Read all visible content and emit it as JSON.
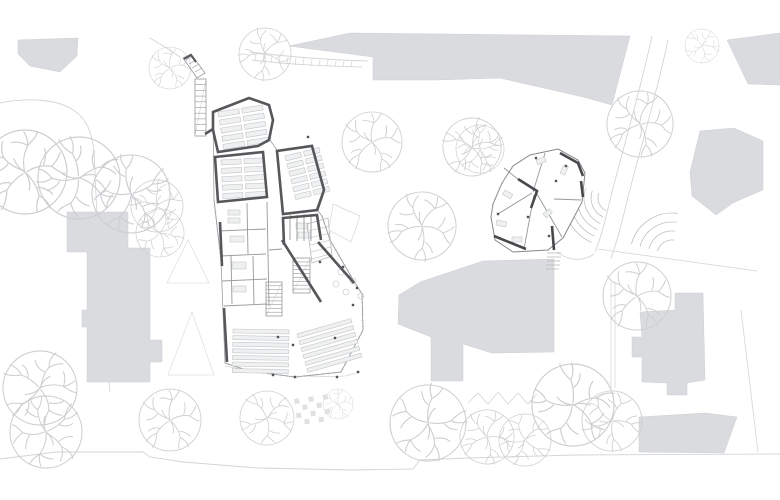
{
  "canvas": {
    "width": 780,
    "height": 500,
    "background": "#ffffff"
  },
  "palette": {
    "context_building_fill": "#d9dbde",
    "context_building_edge": "#cdcfd2",
    "wall": "#55575a",
    "wall_dark": "#47484b",
    "thin_wall": "#96989a",
    "glass": "#9b9d9f",
    "furniture_fill": "#eef0f1",
    "furniture_stroke": "#c3c5c7",
    "tree": "#ccced1",
    "path": "#d3d5d8",
    "detail": "#b6b8ba",
    "dot": "#515254",
    "plan_fill": "#ffffff"
  },
  "site": {
    "context_buildings": [
      {
        "name": "context-building-top-left",
        "points": "18,40 78,38 77,56 60,72 30,66 18,54"
      },
      {
        "name": "context-building-north-mass",
        "points": "289,46 350,33 630,36 612,105 583,97 500,78 437,80 373,80 373,57"
      },
      {
        "name": "context-building-top-right-corner",
        "points": "727,40 780,33 780,85 748,84"
      },
      {
        "name": "context-building-east-house",
        "points": "700,131 734,128 763,141 763,190 744,198 733,203 716,215 692,196 690,172"
      },
      {
        "name": "context-building-center-blob",
        "points": "420,282 483,261 554,259 554,352 492,353 463,344 463,381 431,381 431,337 398,324 399,295"
      },
      {
        "name": "context-building-west-tall",
        "points": "67,212 128,212 128,248 150,248 150,340 162,340 162,362 150,362 150,382 87,382 87,327 82,327 82,310 87,310 87,252 67,252"
      },
      {
        "name": "context-building-southeast-a",
        "points": "640,312 675,310 675,293 703,293 705,380 687,383 687,395 667,395 667,383 642,382 642,357 632,357 632,337 642,337"
      },
      {
        "name": "context-building-southeast-b",
        "points": "639,417 705,413 737,417 724,453 639,452"
      }
    ],
    "boundary_paths": [
      {
        "name": "site-path-west-boundary",
        "d": "M0,103 C30,97 55,100 70,108 C85,116 92,130 94,152 L96,195 C98,240 101,300 106,352 L110,392",
        "w": 0.9
      },
      {
        "name": "site-path-south-walk",
        "d": "M0,459 L56,452 L143,452 L150,457 L183,462 L258,468 L352,470 L413,469 L420,460 L468,458 L575,455 L780,454",
        "w": 0.9
      },
      {
        "name": "site-path-east-walk-a",
        "d": "M652,36 C640,92 622,152 610,200 C606,218 600,240 595,252",
        "w": 0.9
      },
      {
        "name": "site-path-east-walk-b",
        "d": "M668,40 C656,97 638,157 626,205 C622,222 616,245 611,258",
        "w": 0.9
      },
      {
        "name": "site-line-east-property",
        "d": "M598,249 L757,271",
        "w": 0.8
      },
      {
        "name": "site-line-southeast-property",
        "d": "M741,310 L758,452",
        "w": 0.8
      },
      {
        "name": "site-fence-east-1",
        "d": "M611,282 L611,388",
        "w": 0.7
      },
      {
        "name": "site-fence-east-2",
        "d": "M615,282 L615,388",
        "w": 0.7
      },
      {
        "name": "site-hedge-north-1",
        "d": "M250,52 C290,57 330,60 368,61",
        "w": 0.9
      },
      {
        "name": "site-hedge-north-2",
        "d": "M252,60 C292,65 332,66 362,67",
        "w": 0.9
      },
      {
        "name": "site-hedge-north-ticks",
        "d": "M256,53 L255,61 M264,54 L263,62 M272,55 L271,63 M280,56 L279,64 M288,57 L287,64 M296,58 L295,65 M304,58 L303,65 M312,59 L311,66 M320,60 L319,66 M328,60 L327,66 M336,61 L335,67 M344,61 L343,67 M352,61 L351,67",
        "w": 0.7
      },
      {
        "name": "site-hedge-zigzag",
        "d": "M468,403 L478,393 L488,404 L498,392 L508,404 L518,393 L528,404 L537,394",
        "w": 0.8
      },
      {
        "name": "site-path-north-entry",
        "d": "M150,38 C160,44 170,50 180,57",
        "w": 0.8
      },
      {
        "name": "site-path-annex-link",
        "d": "M557,252 C570,262 584,261 594,254",
        "w": 0.8
      },
      {
        "name": "site-fence-school-south",
        "d": "M225,366 C260,373 300,378 345,376 L360,372",
        "w": 0.8
      }
    ],
    "trees": [
      {
        "x": 170,
        "y": 68,
        "r": 21,
        "rot": 0
      },
      {
        "x": 265,
        "y": 54,
        "r": 26,
        "rot": 40
      },
      {
        "x": 702,
        "y": 46,
        "r": 17,
        "rot": 90
      },
      {
        "x": 640,
        "y": 124,
        "r": 33,
        "rot": 15
      },
      {
        "x": 372,
        "y": 142,
        "r": 30,
        "rot": 0
      },
      {
        "x": 472,
        "y": 147,
        "r": 29,
        "rot": 70
      },
      {
        "x": 422,
        "y": 226,
        "r": 34,
        "rot": 30
      },
      {
        "x": 25,
        "y": 172,
        "r": 42,
        "rot": 0
      },
      {
        "x": 79,
        "y": 178,
        "r": 41,
        "rot": 120
      },
      {
        "x": 131,
        "y": 194,
        "r": 39,
        "rot": 200
      },
      {
        "x": 157,
        "y": 206,
        "r": 26,
        "rot": 60
      },
      {
        "x": 160,
        "y": 233,
        "r": 24,
        "rot": 160
      },
      {
        "x": 480,
        "y": 149,
        "r": 24,
        "rot": 210
      },
      {
        "x": 637,
        "y": 296,
        "r": 34,
        "rot": 0
      },
      {
        "x": 40,
        "y": 388,
        "r": 37,
        "rot": 80
      },
      {
        "x": 46,
        "y": 432,
        "r": 36,
        "rot": 190
      },
      {
        "x": 170,
        "y": 420,
        "r": 31,
        "rot": 0
      },
      {
        "x": 267,
        "y": 418,
        "r": 27,
        "rot": 100
      },
      {
        "x": 338,
        "y": 404,
        "r": 15,
        "rot": 0
      },
      {
        "x": 428,
        "y": 423,
        "r": 38,
        "rot": 220
      },
      {
        "x": 487,
        "y": 437,
        "r": 27,
        "rot": 20
      },
      {
        "x": 525,
        "y": 440,
        "r": 26,
        "rot": 260
      },
      {
        "x": 573,
        "y": 405,
        "r": 41,
        "rot": 130
      },
      {
        "x": 612,
        "y": 421,
        "r": 30,
        "rot": 310
      }
    ],
    "conifer_triangles": [
      {
        "points": "167,283 188,240 209,283"
      },
      {
        "points": "168,375 192,312 214,375"
      }
    ],
    "arc_stairs": [
      {
        "name": "landscape-stair-arcs-annex",
        "cx": 612,
        "cy": 198,
        "radii": [
          14,
          21,
          28,
          35,
          42,
          49
        ],
        "a0": 115,
        "a1": 200
      },
      {
        "name": "landscape-stair-arcs-east",
        "cx": 672,
        "cy": 255,
        "radii": [
          15,
          24,
          33,
          42
        ],
        "a0": 195,
        "a1": 278
      }
    ],
    "checker_plaza": {
      "x": 294,
      "y": 399,
      "rows": 4,
      "cols": 5,
      "cell": 5,
      "gap": 2.2,
      "rot": -8
    }
  },
  "main_building": {
    "name": "main-school-building",
    "footprint": "M213,112 L249,98 L269,105 L273,120 L270,140 L277,150 L312,145 L325,190 L318,211 L322,216 L330,240 L352,278 L362,294 L363,330 L341,372 L295,377 L249,371 L225,363 L221,260 L214,200 Z",
    "thick_walls": [
      "M213,112 L249,98 L269,105 L273,120 L269,140 L258,146 L218,152 L213,130 Z",
      "M215,157 L263,152 L267,197 L218,202 Z",
      "M277,151 L312,146 L324,190 L317,210 L283,214 Z",
      "M284,245 L283,218 L317,215 L321,240",
      "M318,242 L354,283",
      "M282,240 L321,302",
      "M220,222 L222,266",
      "M224,308 L227,362",
      "M205,134 L213,129"
    ],
    "thin_walls": [
      "M219,231 L266,229",
      "M220,256 L266,254",
      "M222,281 L267,279",
      "M224,306 L267,304",
      "M247,203 L248,254",
      "M231,256 L232,304",
      "M253,256 L254,304",
      "M267,202 L269,306",
      "M290,215 L290,240",
      "M297,215 L297,241",
      "M304,214 L304,241",
      "M311,214 L311,241",
      "M269,250 L282,249"
    ],
    "glass_mullions": [
      "M322,216 L330,240 L352,278 L362,294 L363,330 L341,372",
      "M341,372 L295,377 L249,371 L225,363",
      "M221,260 L214,200"
    ],
    "stairs": [
      {
        "x": 293,
        "y": 258,
        "w": 17,
        "h": 35,
        "steps": 9
      },
      {
        "x": 266,
        "y": 282,
        "w": 16,
        "h": 34,
        "steps": 9
      },
      {
        "x": 195,
        "y": 79,
        "w": 11,
        "h": 57,
        "steps": 10
      }
    ],
    "entrance_ramp": {
      "outline": "M183,58 L191,54 L205,73 L197,78 Z",
      "treads": "M186,60 L193,56 M189,64 L196,60 M192,68 L199,64 M195,72 L202,68",
      "dark_corner": "M184,59 L191,55 L196,62"
    },
    "table_grids": [
      {
        "name": "classroom-tables-a",
        "x": 218,
        "y": 112,
        "rows": 5,
        "cols": 2,
        "cellW": 21,
        "cellH": 5,
        "gapX": 3,
        "gapY": 3.2,
        "rot": -9
      },
      {
        "name": "classroom-tables-b",
        "x": 221,
        "y": 160,
        "rows": 5,
        "cols": 2,
        "cellW": 20,
        "cellH": 5,
        "gapX": 3,
        "gapY": 3.4,
        "rot": -3
      },
      {
        "name": "classroom-tables-c",
        "x": 285,
        "y": 156,
        "rows": 6,
        "cols": 2,
        "cellW": 16,
        "cellH": 5,
        "gapX": 3,
        "gapY": 3,
        "rot": -14
      },
      {
        "name": "canteen-rows-west",
        "x": 233,
        "y": 329,
        "rows": 7,
        "cols": 1,
        "cellW": 56,
        "cellH": 4,
        "gapX": 0,
        "gapY": 2.6,
        "rot": 1
      },
      {
        "name": "canteen-rows-east",
        "x": 297,
        "y": 334,
        "rows": 6,
        "cols": 1,
        "cellW": 56,
        "cellH": 4,
        "gapX": 0,
        "gapY": 3.2,
        "rot": -16
      }
    ],
    "extra_furniture": [
      {
        "x": 296,
        "y": 223,
        "w": 12,
        "h": 6,
        "rot": 0
      },
      {
        "x": 298,
        "y": 232,
        "w": 12,
        "h": 6,
        "rot": 0
      },
      {
        "x": 228,
        "y": 210,
        "w": 12,
        "h": 5,
        "rot": 0
      },
      {
        "x": 228,
        "y": 218,
        "w": 12,
        "h": 5,
        "rot": 0
      },
      {
        "x": 230,
        "y": 236,
        "w": 14,
        "h": 6,
        "rot": 0
      },
      {
        "x": 232,
        "y": 262,
        "w": 14,
        "h": 7,
        "rot": 0
      },
      {
        "x": 233,
        "y": 286,
        "w": 13,
        "h": 6,
        "rot": 0
      }
    ],
    "hatch_area": {
      "outline": "M307,224 L328,218 L332,256 L312,263 Z",
      "lines": "M308,231 L330,226 M309,238 L331,233 M310,245 L331,240 M311,252 L331,247 M312,259 L330,254"
    },
    "faint_terrace": "M333,204 L360,216 L351,242 L329,230 Z",
    "plaza_circles": [
      [
        341,
        272
      ],
      [
        353,
        281
      ],
      [
        346,
        292
      ],
      [
        361,
        296
      ],
      [
        336,
        284
      ]
    ],
    "dots": [
      [
        308,
        137
      ],
      [
        320,
        262
      ],
      [
        343,
        267
      ],
      [
        349,
        277
      ],
      [
        357,
        288
      ],
      [
        353,
        305
      ],
      [
        335,
        338
      ],
      [
        278,
        337
      ],
      [
        293,
        345
      ],
      [
        273,
        375
      ],
      [
        295,
        377
      ],
      [
        337,
        377
      ],
      [
        358,
        372
      ]
    ]
  },
  "annex_building": {
    "name": "annex-building",
    "outline": "530,155 558,149 578,160 585,173 582,202 563,238 548,250 513,252 495,240 491,217 493,204 502,183 513,166",
    "thick_walls": [
      "M560,153 L578,163 L583,176",
      "M581,181 L583,197",
      "M494,236 L526,249",
      "M518,179 L537,191 L531,208",
      "M552,226 L554,250"
    ],
    "thin_walls": [
      "M533,192 L545,153",
      "M532,193 L498,214",
      "M534,195 L524,249",
      "M537,194 L562,237",
      "M519,180 L504,168",
      "M554,199 L581,200"
    ],
    "glass_mullions": [
      "M491,217 L493,204 L502,183 L513,166"
    ],
    "furniture": [
      {
        "x": 536,
        "y": 160,
        "w": 9,
        "h": 5,
        "rot": -20
      },
      {
        "x": 560,
        "y": 173,
        "w": 9,
        "h": 5,
        "rot": -65
      },
      {
        "x": 497,
        "y": 220,
        "w": 10,
        "h": 5,
        "rot": 12
      },
      {
        "x": 512,
        "y": 237,
        "w": 10,
        "h": 5,
        "rot": 0
      },
      {
        "x": 543,
        "y": 214,
        "w": 8,
        "h": 5,
        "rot": -40
      },
      {
        "x": 505,
        "y": 190,
        "w": 9,
        "h": 5,
        "rot": 30
      }
    ],
    "south_steps": "M547,253 L561,253 M547,257 L561,257 M547,261 L560,261 M546,265 L560,265 M546,269 L559,269",
    "dots": [
      [
        556,
        181
      ],
      [
        528,
        217
      ],
      [
        498,
        214
      ],
      [
        549,
        236
      ],
      [
        566,
        166
      ],
      [
        536,
        158
      ]
    ]
  }
}
